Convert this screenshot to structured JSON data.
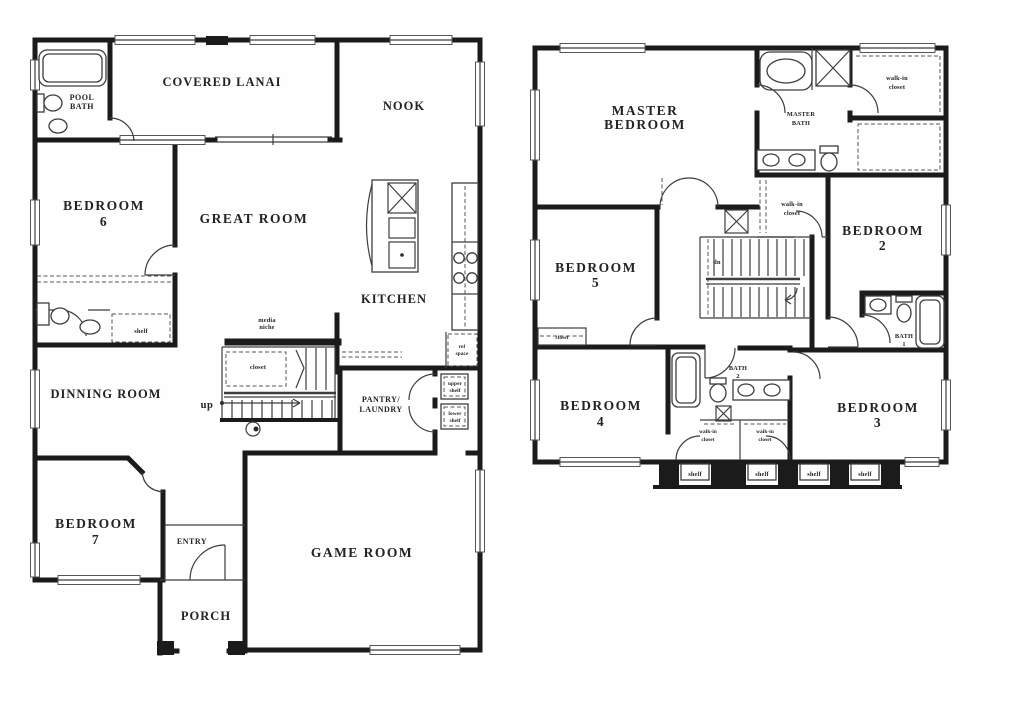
{
  "colors": {
    "wall": "#1b1b1b",
    "thin_line": "#3d3d3d",
    "text": "#232323",
    "background": "#fefefe"
  },
  "floor1": {
    "labels": {
      "pool_bath": [
        "POOL",
        "BATH"
      ],
      "covered_lanai": [
        "COVERED LANAI"
      ],
      "nook": [
        "NOOK"
      ],
      "bedroom6": [
        "BEDROOM",
        "6"
      ],
      "great_room": [
        "GREAT ROOM"
      ],
      "kitchen": [
        "KITCHEN"
      ],
      "bath_shelf": [
        "shelf"
      ],
      "media_niche": [
        "media",
        "niche"
      ],
      "stair_closet": [
        "closet"
      ],
      "up": [
        "up"
      ],
      "dining_room": [
        "DINNING ROOM"
      ],
      "pantry_laundry": [
        "PANTRY/",
        "LAUNDRY"
      ],
      "ref_space": [
        "ref",
        "space"
      ],
      "upper_shelf": [
        "upper",
        "shelf"
      ],
      "lower_shelf": [
        "lower",
        "shelf"
      ],
      "bedroom7": [
        "BEDROOM",
        "7"
      ],
      "entry": [
        "ENTRY"
      ],
      "porch": [
        "PORCH"
      ],
      "game_room": [
        "GAME ROOM"
      ]
    }
  },
  "floor2": {
    "labels": {
      "master_bedroom": [
        "MASTER",
        "BEDROOM"
      ],
      "master_bath": [
        "MASTER",
        "BATH"
      ],
      "walkin_closet_top": [
        "walk-in",
        "closet"
      ],
      "walkin_closet_mid": [
        "walk-in",
        "closet"
      ],
      "bedroom2": [
        "BEDROOM",
        "2"
      ],
      "bedroom5": [
        "BEDROOM",
        "5"
      ],
      "bedroom5_closet": [
        "closet"
      ],
      "stairs_dn": [
        "dn"
      ],
      "bath1": [
        "BATH",
        "1"
      ],
      "bedroom4": [
        "BEDROOM",
        "4"
      ],
      "bath2": [
        "BATH",
        "2"
      ],
      "walkin_closet_left": [
        "walk-in",
        "closet"
      ],
      "walkin_closet_right": [
        "walk-in",
        "closet"
      ],
      "bedroom3": [
        "BEDROOM",
        "3"
      ],
      "shelves": [
        "shelf",
        "shelf",
        "shelf",
        "shelf"
      ]
    }
  }
}
